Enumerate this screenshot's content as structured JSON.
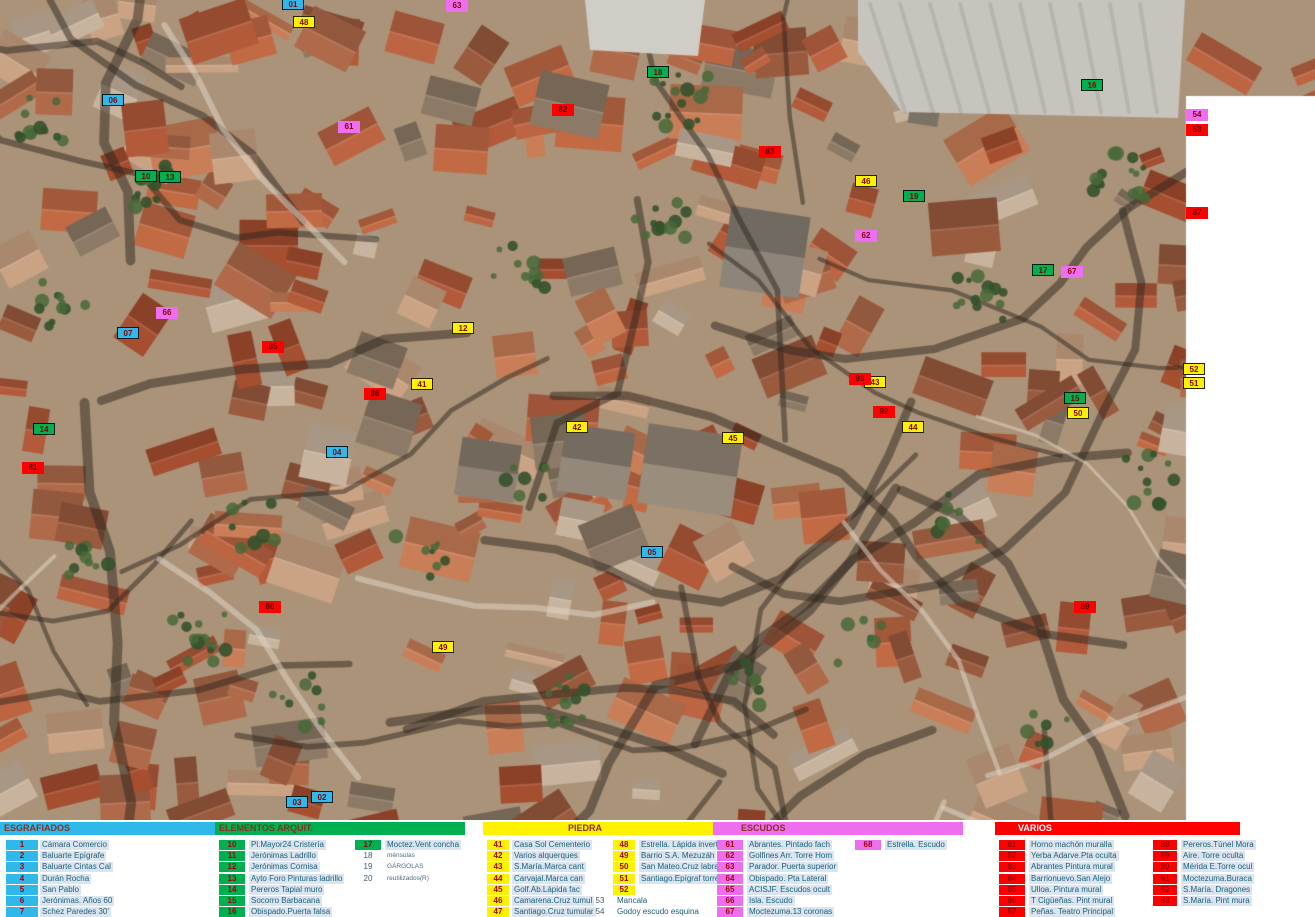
{
  "map": {
    "description": "aerial-orthophoto-historic-town",
    "white_margin_color": "#ffffff"
  },
  "marker_colors": {
    "blue": "#2fb9ea",
    "green": "#00b050",
    "yellow": "#fff200",
    "magenta": "#ef6ef0",
    "red": "#fe0000"
  },
  "legend": {
    "panels": [
      {
        "id": "esgrafiados",
        "header": "ESGRAFIADOS",
        "color": "#2fb9ea",
        "header_text_color": "#8a2e1e",
        "items": [
          {
            "n": "1",
            "label": "Cámara Comercio"
          },
          {
            "n": "2",
            "label": "Baluarte  Epígrafe"
          },
          {
            "n": "3",
            "label": "Baluarte Cintas Cal"
          },
          {
            "n": "4",
            "label": "Durán Rocha"
          },
          {
            "n": "5",
            "label": "San Pablo"
          },
          {
            "n": "6",
            "label": "Jerónimas. Años 60"
          },
          {
            "n": "7",
            "label": "Schez Paredes 30'"
          }
        ],
        "items2": []
      },
      {
        "id": "elementos",
        "header": "ELEMENTOS ARQUIT.",
        "color": "#00b050",
        "header_text_color": "#8a2e1e",
        "items": [
          {
            "n": "10",
            "label": "Pl.Mayor24 Cristería"
          },
          {
            "n": "11",
            "label": "Jerónimas Ladrillo"
          },
          {
            "n": "12",
            "label": "Jerónimas Cornisa"
          },
          {
            "n": "13",
            "label": "Ayto Foro Pinturas ladrillo"
          },
          {
            "n": "14",
            "label": "Pereros Tapial muro"
          },
          {
            "n": "15",
            "label": "Socorro Barbacana"
          },
          {
            "n": "16",
            "label": "Obispado.Puerta falsa"
          }
        ],
        "items2": [
          {
            "n": "17",
            "label": "Moctez.Vent concha"
          },
          {
            "n": "18",
            "label": "ménsulas",
            "nochip": true,
            "tiny": true
          },
          {
            "n": "19",
            "label": "GÁRGOLAS",
            "nochip": true,
            "tiny": true
          },
          {
            "n": "20",
            "label": "reutilizados(R)",
            "nochip": true,
            "tiny": true
          }
        ]
      },
      {
        "id": "piedra",
        "header": "PIEDRA",
        "color": "#fff200",
        "header_text_color": "#8a2e1e",
        "items": [
          {
            "n": "41",
            "label": "Casa Sol Cementerio"
          },
          {
            "n": "42",
            "label": "Varios  alquerques"
          },
          {
            "n": "43",
            "label": "S.María.Marca cant"
          },
          {
            "n": "44",
            "label": "Carvajal.Marca can"
          },
          {
            "n": "45",
            "label": "Golf.Ab.Lápida fac"
          },
          {
            "n": "46",
            "label": "Camarena.Cruz tumul"
          },
          {
            "n": "47",
            "label": "Santiago.Cruz tumular"
          }
        ],
        "items2": [
          {
            "n": "48",
            "label": "Estrella. Lápida invertid"
          },
          {
            "n": "49",
            "label": "Barrio S.A. Mezuzáh"
          },
          {
            "n": "50",
            "label": "San Mateo.Cruz labrada"
          },
          {
            "n": "51",
            "label": "Santiago.Epígraf torre"
          },
          {
            "n": "52",
            "label": ""
          },
          {
            "n": "53",
            "label": "Mancala",
            "nochip": true
          },
          {
            "n": "54",
            "label": "Godoy escudo esquina",
            "nochip": true
          }
        ]
      },
      {
        "id": "escudos",
        "header": "ESCUDOS",
        "color": "#ef6ef0",
        "header_text_color": "#8a2e1e",
        "items": [
          {
            "n": "61",
            "label": "Abrantes. Pintado fach"
          },
          {
            "n": "62",
            "label": "Golfines Arr. Torre Hom"
          },
          {
            "n": "63",
            "label": "Parador. Puerta superior"
          },
          {
            "n": "64",
            "label": "Obispado. Pta Lateral"
          },
          {
            "n": "65",
            "label": "ACISJF. Escudos ocult"
          },
          {
            "n": "66",
            "label": "Isla. Escudo"
          },
          {
            "n": "67",
            "label": "Moctezuma.13 coronas"
          }
        ],
        "items2": [
          {
            "n": "68",
            "label": "Estrella. Escudo"
          }
        ]
      },
      {
        "id": "varios",
        "header": "VARIOS",
        "color": "#fe0000",
        "header_text_color": "#ffffff",
        "items": [
          {
            "n": "81",
            "label": "Horno  machón muralla"
          },
          {
            "n": "82",
            "label": "Yerba Adarve.Pta oculta"
          },
          {
            "n": "83",
            "label": "Abrantes Pintura mural"
          },
          {
            "n": "84",
            "label": "Barrionuevo.San Alejo"
          },
          {
            "n": "85",
            "label": "Ulloa. Pintura mural"
          },
          {
            "n": "86",
            "label": "T Cigüeñas. Pint mural"
          },
          {
            "n": "87",
            "label": "Peñas. Teatro Principal"
          }
        ],
        "items2": [
          {
            "n": "88",
            "label": "Pereros.Túnel Mora"
          },
          {
            "n": "89",
            "label": "Aire. Torre oculta"
          },
          {
            "n": "90",
            "label": "Mérida E.Torre ocul"
          },
          {
            "n": "91",
            "label": "Moctezuma.Buraca"
          },
          {
            "n": "92",
            "label": "S.María. Dragones"
          },
          {
            "n": "93",
            "label": "S.María. Pint mura"
          }
        ]
      }
    ]
  },
  "markers": [
    {
      "x": 293,
      "y": 4,
      "color": "blue",
      "label": "01"
    },
    {
      "x": 113,
      "y": 100,
      "color": "blue",
      "label": "06"
    },
    {
      "x": 128,
      "y": 333,
      "color": "blue",
      "label": "07"
    },
    {
      "x": 337,
      "y": 452,
      "color": "blue",
      "label": "04"
    },
    {
      "x": 652,
      "y": 552,
      "color": "blue",
      "label": "05"
    },
    {
      "x": 297,
      "y": 802,
      "color": "blue",
      "label": "03"
    },
    {
      "x": 322,
      "y": 797,
      "color": "blue",
      "label": "02"
    },
    {
      "x": 146,
      "y": 176,
      "color": "green",
      "label": "10"
    },
    {
      "x": 170,
      "y": 177,
      "color": "green",
      "label": "13"
    },
    {
      "x": 658,
      "y": 72,
      "color": "green",
      "label": "18"
    },
    {
      "x": 914,
      "y": 196,
      "color": "green",
      "label": "19"
    },
    {
      "x": 1092,
      "y": 85,
      "color": "green",
      "label": "16"
    },
    {
      "x": 1043,
      "y": 270,
      "color": "green",
      "label": "17"
    },
    {
      "x": 1075,
      "y": 398,
      "color": "green",
      "label": "15"
    },
    {
      "x": 44,
      "y": 429,
      "color": "green",
      "label": "14"
    },
    {
      "x": 304,
      "y": 22,
      "color": "yellow",
      "label": "48"
    },
    {
      "x": 866,
      "y": 181,
      "color": "yellow",
      "label": "46"
    },
    {
      "x": 463,
      "y": 328,
      "color": "yellow",
      "label": "12"
    },
    {
      "x": 422,
      "y": 384,
      "color": "yellow",
      "label": "41"
    },
    {
      "x": 577,
      "y": 427,
      "color": "yellow",
      "label": "42"
    },
    {
      "x": 733,
      "y": 438,
      "color": "yellow",
      "label": "45"
    },
    {
      "x": 875,
      "y": 382,
      "color": "yellow",
      "label": "43"
    },
    {
      "x": 913,
      "y": 427,
      "color": "yellow",
      "label": "44"
    },
    {
      "x": 1078,
      "y": 413,
      "color": "yellow",
      "label": "50"
    },
    {
      "x": 1194,
      "y": 369,
      "color": "yellow",
      "label": "52"
    },
    {
      "x": 1194,
      "y": 383,
      "color": "yellow",
      "label": "51"
    },
    {
      "x": 443,
      "y": 647,
      "color": "yellow",
      "label": "49"
    },
    {
      "x": 457,
      "y": 6,
      "color": "magenta",
      "label": "63"
    },
    {
      "x": 349,
      "y": 127,
      "color": "magenta",
      "label": "61"
    },
    {
      "x": 866,
      "y": 236,
      "color": "magenta",
      "label": "62"
    },
    {
      "x": 167,
      "y": 313,
      "color": "magenta",
      "label": "66"
    },
    {
      "x": 1072,
      "y": 272,
      "color": "magenta",
      "label": "67"
    },
    {
      "x": 1197,
      "y": 115,
      "color": "magenta",
      "label": "54"
    },
    {
      "x": 563,
      "y": 110,
      "color": "red",
      "label": "82"
    },
    {
      "x": 770,
      "y": 152,
      "color": "red",
      "label": "83"
    },
    {
      "x": 1197,
      "y": 130,
      "color": "red",
      "label": "53"
    },
    {
      "x": 1197,
      "y": 213,
      "color": "red",
      "label": "87"
    },
    {
      "x": 273,
      "y": 347,
      "color": "red",
      "label": "85"
    },
    {
      "x": 375,
      "y": 394,
      "color": "red",
      "label": "86"
    },
    {
      "x": 860,
      "y": 379,
      "color": "red",
      "label": "93"
    },
    {
      "x": 884,
      "y": 412,
      "color": "red",
      "label": "92"
    },
    {
      "x": 33,
      "y": 468,
      "color": "red",
      "label": "81"
    },
    {
      "x": 270,
      "y": 607,
      "color": "red",
      "label": "88"
    },
    {
      "x": 1085,
      "y": 607,
      "color": "red",
      "label": "89"
    }
  ]
}
